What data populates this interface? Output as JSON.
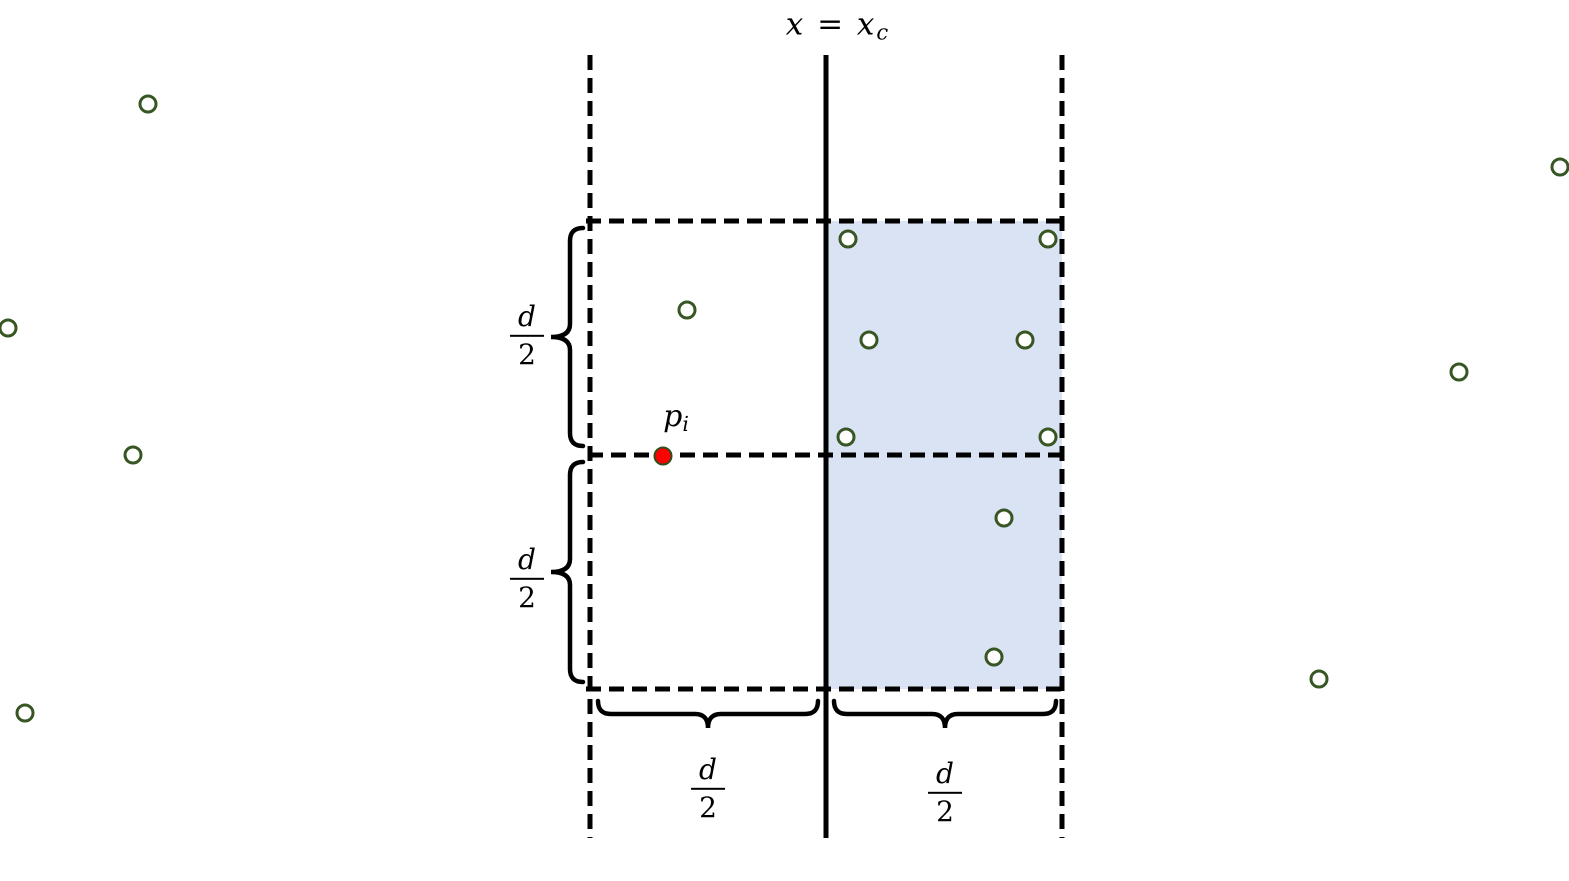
{
  "title": {
    "text_main": "x = x",
    "text_sub": "c"
  },
  "labels": {
    "point_label": {
      "base": "p",
      "sub": "i"
    },
    "half_d": {
      "numerator": "d",
      "denominator": "2"
    }
  },
  "colors": {
    "point_stroke": "#375623",
    "point_fill": "#ffffff",
    "special_point_fill": "#fe0000",
    "special_point_rim": "#334d1d",
    "shaded_region_fill": "#dae3f3",
    "line_color": "#000000"
  },
  "diagram": {
    "description": "Vertical strip of width d around dividing line x = x_c; right half strip cells of size d/2 shaded; candidate point p_i on the strip midline",
    "points": [
      {
        "x": 148,
        "y": 104,
        "region": "outside-left"
      },
      {
        "x": 8,
        "y": 328,
        "region": "outside-left"
      },
      {
        "x": 133,
        "y": 455,
        "region": "outside-left"
      },
      {
        "x": 25,
        "y": 713,
        "region": "outside-left"
      },
      {
        "x": 1560,
        "y": 167,
        "region": "outside-right"
      },
      {
        "x": 1459,
        "y": 372,
        "region": "outside-right"
      },
      {
        "x": 1319,
        "y": 679,
        "region": "outside-right"
      },
      {
        "x": 687,
        "y": 310,
        "region": "left-strip-top-cell"
      },
      {
        "x": 848,
        "y": 239,
        "region": "right-strip-top-cell"
      },
      {
        "x": 1048,
        "y": 239,
        "region": "right-strip-top-cell"
      },
      {
        "x": 869,
        "y": 340,
        "region": "right-strip-top-cell"
      },
      {
        "x": 1025,
        "y": 340,
        "region": "right-strip-top-cell"
      },
      {
        "x": 846,
        "y": 437,
        "region": "right-strip-top-cell"
      },
      {
        "x": 1048,
        "y": 437,
        "region": "right-strip-top-cell"
      },
      {
        "x": 1004,
        "y": 518,
        "region": "right-strip-bottom-cell"
      },
      {
        "x": 994,
        "y": 657,
        "region": "right-strip-bottom-cell"
      }
    ],
    "special_point": {
      "x": 663,
      "y": 456,
      "label": "p_i"
    }
  }
}
